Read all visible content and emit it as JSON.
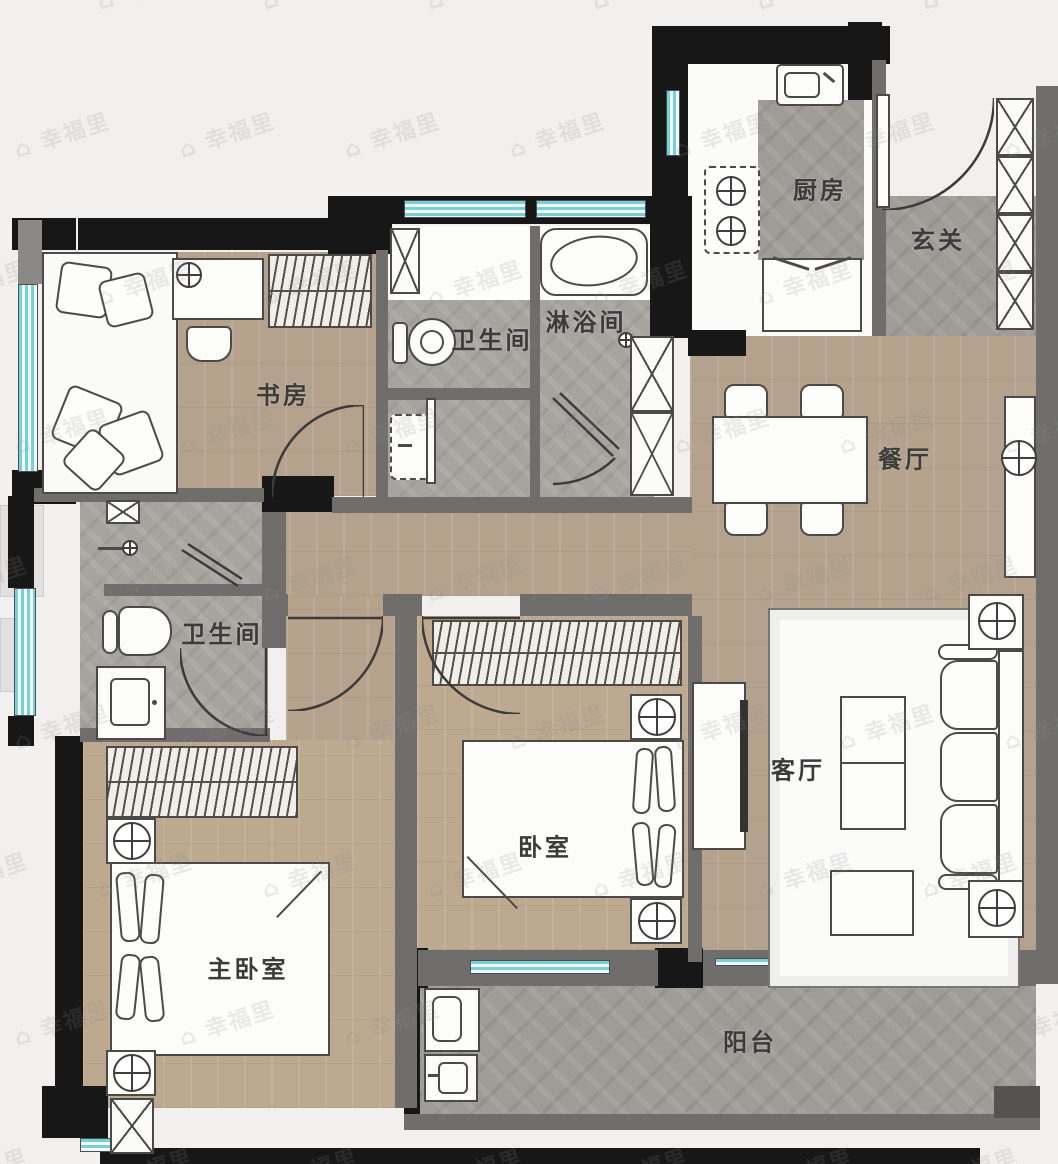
{
  "watermark": {
    "text": "幸福里",
    "icon": "house-icon"
  },
  "rooms": {
    "study": "书房",
    "bath_top": "卫生间",
    "shower": "淋浴间",
    "kitchen": "厨房",
    "foyer": "玄关",
    "dining": "餐厅",
    "living": "客厅",
    "bedroom": "卧室",
    "master": "主卧室",
    "bath_bottom": "卫生间",
    "balcony": "阳台"
  },
  "colors": {
    "wood_floor": "#b5a28c",
    "tile_floor": "#a7a49f",
    "window_glass": "#79ced7",
    "wall_dark": "#171717",
    "wall_gray": "#6f6e6c",
    "label_text": "#3b3b3b",
    "furniture_outline": "#4c4a48"
  }
}
